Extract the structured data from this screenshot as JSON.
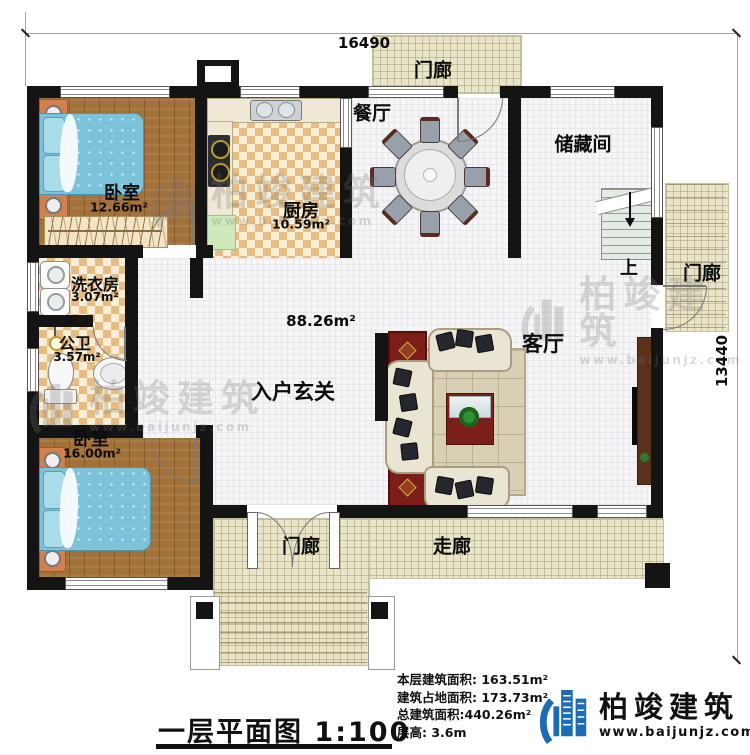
{
  "meta": {
    "title": "一层平面图",
    "scale": "1:100"
  },
  "dimensions": {
    "width_mm": "16490",
    "depth_mm": "13440"
  },
  "rooms": {
    "bedroom1": {
      "label": "卧室",
      "area": "12.66m²"
    },
    "kitchen": {
      "label": "厨房",
      "area": "10.59m²"
    },
    "dining": {
      "label": "餐厅"
    },
    "porch_top": {
      "label": "门廊"
    },
    "storage": {
      "label": "储藏间"
    },
    "stairs": {
      "label": "上"
    },
    "porch_right": {
      "label": "门廊"
    },
    "laundry": {
      "label": "洗衣房",
      "area": "3.07m²"
    },
    "bathroom": {
      "label": "公卫",
      "area": "3.57m²"
    },
    "bedroom2": {
      "label": "卧室",
      "area": "16.00m²"
    },
    "hall": {
      "label": "入户玄关"
    },
    "living": {
      "label": "客厅"
    },
    "open_area": {
      "area": "88.26m²"
    },
    "porch_bottom": {
      "label": "门廊"
    },
    "corridor": {
      "label": "走廊"
    }
  },
  "stats": {
    "floor_area": {
      "label": "本层建筑面积:",
      "value": "163.51m²"
    },
    "footprint": {
      "label": "建筑占地面积:",
      "value": "173.73m²"
    },
    "total_area": {
      "label": "总建筑面积:",
      "value": "440.26m²"
    },
    "height": {
      "label": "层高:",
      "value": "3.6m"
    }
  },
  "brand": {
    "name": "柏竣建筑",
    "website": "www.baijunjz.com"
  },
  "watermark": {
    "name": "柏竣建筑",
    "website": "www.baijunjz.com"
  },
  "colors": {
    "wall": "#141414",
    "wood_floor": "#a3713a",
    "kitchen_checker": "#e4bc84",
    "tile": "#f6f6f8",
    "porch": "#eae5c9",
    "bed_blue": "#7cc3da",
    "brand_blue": "#1a6cb5",
    "rug_red": "#7c1d17"
  }
}
